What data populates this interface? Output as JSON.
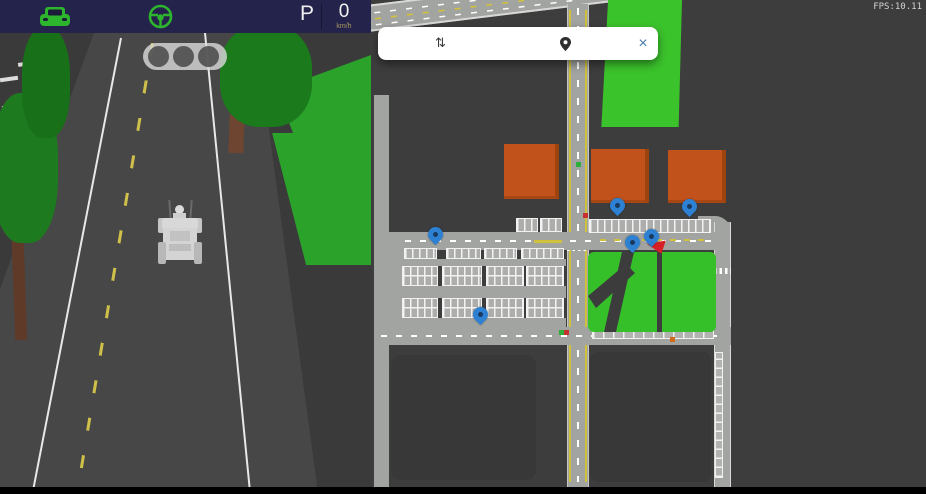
{
  "header": {
    "gear_label": "P",
    "speed_value": "0",
    "speed_unit": "km/h",
    "car_icon": "car-icon",
    "steering_icon": "steering-wheel-icon",
    "icon_color": "#2db52d",
    "bar_color": "#23234b"
  },
  "scene": {
    "traffic_light_lamps": 3,
    "vehicle": "delivery-robot"
  },
  "map": {
    "fps_label": "FPS:10.11",
    "search": {
      "origin_icon": "swap-vertical-icon",
      "origin_glyph": "⇅",
      "destination_icon": "location-pin-icon",
      "close_label": "×"
    },
    "markers": [
      {
        "type": "pin",
        "x": 65,
        "y": 245
      },
      {
        "type": "pin",
        "x": 110,
        "y": 325
      },
      {
        "type": "pin",
        "x": 247,
        "y": 216
      },
      {
        "type": "pin",
        "x": 319,
        "y": 217
      },
      {
        "type": "pin",
        "x": 262,
        "y": 253
      },
      {
        "type": "pin",
        "x": 281,
        "y": 247
      },
      {
        "type": "arrow",
        "x": 276,
        "y": 238
      },
      {
        "type": "mini",
        "x": 188,
        "y": 330,
        "color": "#2fae3a"
      },
      {
        "type": "mini",
        "x": 193,
        "y": 330,
        "color": "#c53030"
      },
      {
        "type": "mini",
        "x": 299,
        "y": 337,
        "color": "#d06a18"
      },
      {
        "type": "mini",
        "x": 212,
        "y": 213,
        "color": "#c53030"
      },
      {
        "type": "mini",
        "x": 205,
        "y": 162,
        "color": "#2fae3a"
      }
    ],
    "colors": {
      "background": "#3d3d3d",
      "road": "#a2a4a1",
      "park_green": "#35c02a",
      "building_orange": "#c2521c",
      "pin_blue": "#2e80d2",
      "arrow_red": "#d62025",
      "lane_yellow": "#d2c23a"
    }
  }
}
